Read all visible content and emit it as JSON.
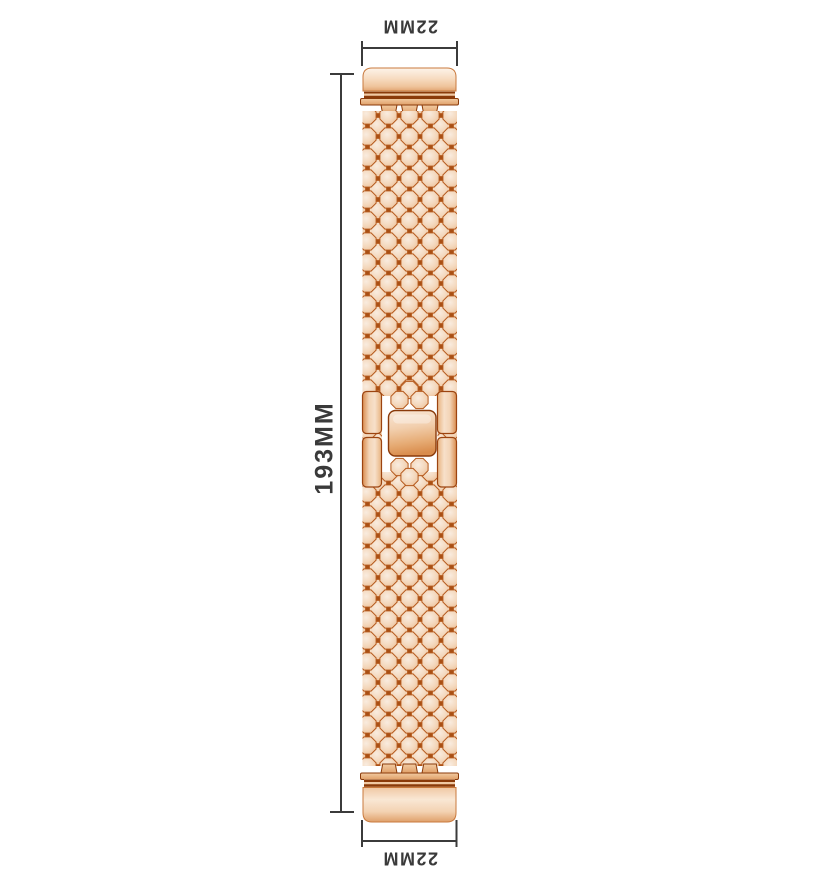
{
  "annotations": {
    "top_width_label": "22MM",
    "bottom_width_label": "22MM",
    "length_label": "193MM"
  },
  "figure": {
    "subject": "rose-gold metal watch band with fish-scale links, end connectors and center fold-over clasp",
    "orientation": "vertical",
    "colors": {
      "dimension_line": "#3b3b3b",
      "label_text": "#3a3a3a",
      "scale_fill_light": "#f7e3cf",
      "scale_fill_mid": "#f2d2b4",
      "scale_outline": "#b5591c",
      "interstice_dark": "#a84f14",
      "connector_light": "#fdf4ea",
      "connector_shade": "#e8b285",
      "clasp_dark_edge": "#8a3a0a",
      "background": "#ffffff"
    }
  }
}
